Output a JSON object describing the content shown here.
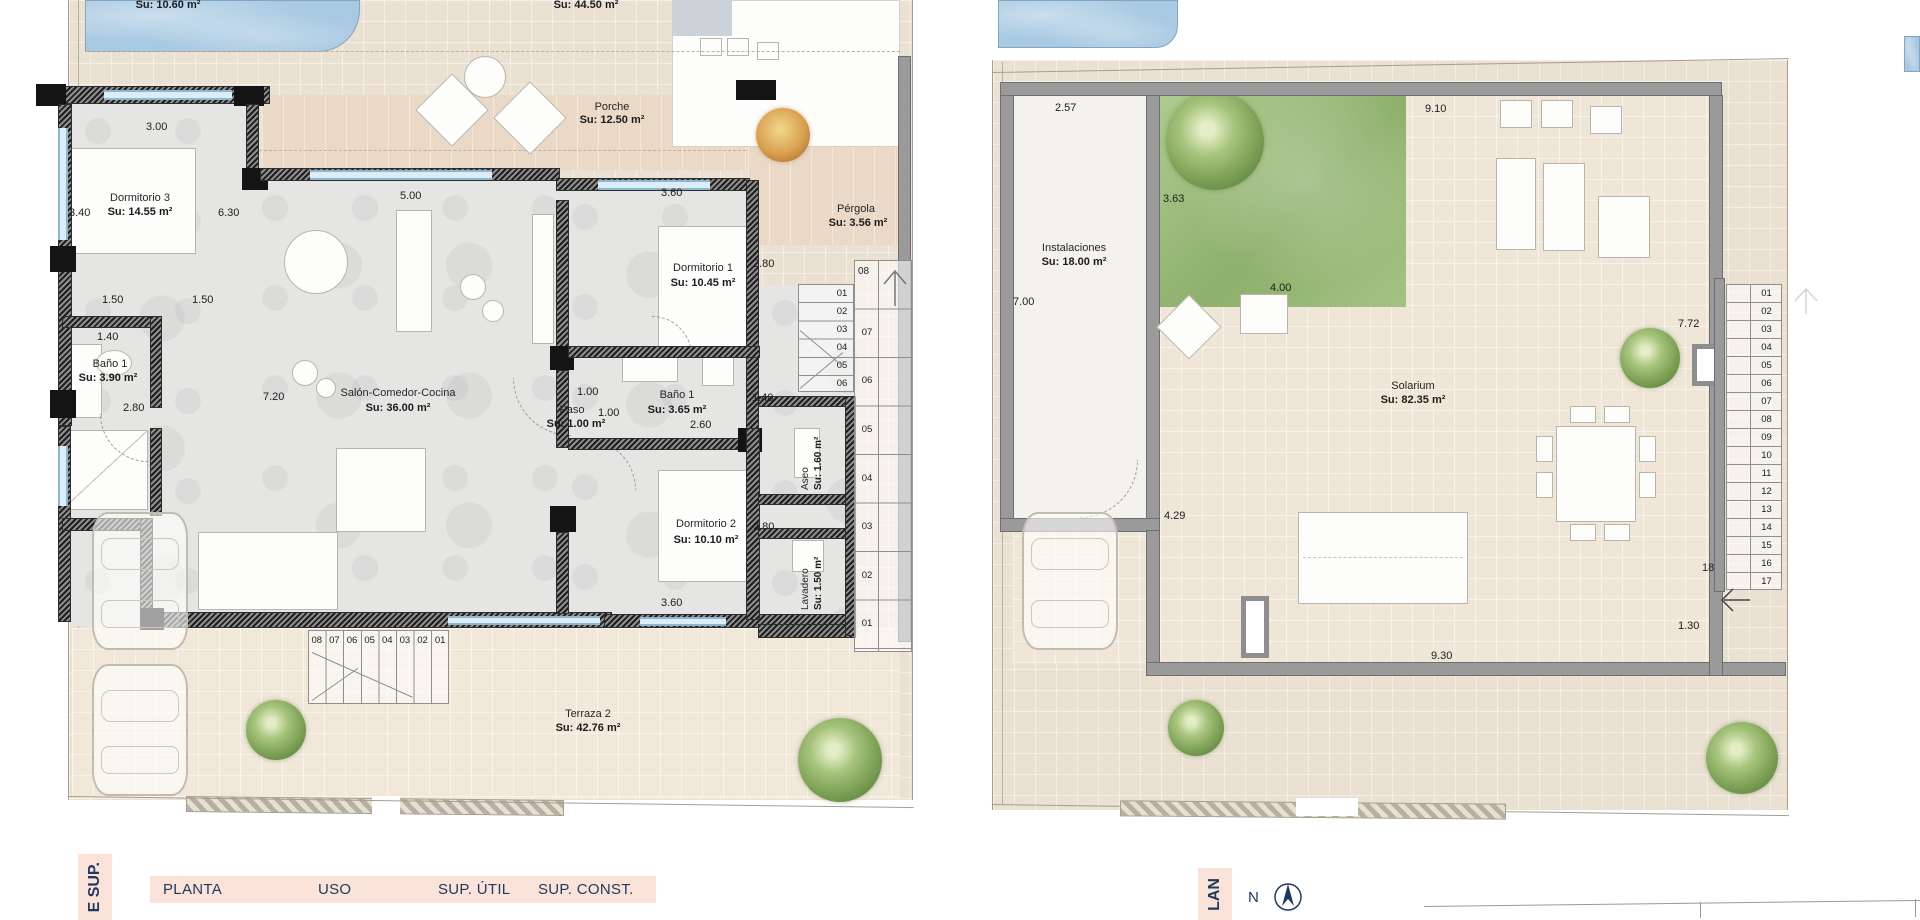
{
  "left_plan": {
    "outdoor": {
      "pool_area": "Su: 10.60 m²",
      "terrace_top_area": "Su: 44.50 m²",
      "porche_name": "Porche",
      "porche_area": "Su: 12.50 m²",
      "pergola_name": "Pérgola",
      "pergola_area": "Su: 3.56 m²",
      "terraza2_name": "Terraza 2",
      "terraza2_area": "Su: 42.76 m²"
    },
    "rooms": {
      "dorm3_name": "Dormitorio 3",
      "dorm3_area": "Su: 14.55 m²",
      "bano1_name": "Baño 1",
      "bano1_area": "Su: 3.90 m²",
      "salon_name": "Salón-Comedor-Cocina",
      "salon_area": "Su: 36.00 m²",
      "dorm1_name": "Dormitorio 1",
      "dorm1_area": "Su: 10.45 m²",
      "paso_name": "Paso",
      "paso_area": "Su: 1.00 m²",
      "bano2_name": "Baño 1",
      "bano2_area": "Su: 3.65 m²",
      "dorm2_name": "Dormitorio 2",
      "dorm2_area": "Su: 10.10 m²",
      "aseo_name": "Aseo",
      "aseo_area": "Su: 1.60 m²",
      "lavadero_name": "Lavadero",
      "lavadero_area": "Su: 1.50 m²"
    },
    "dims": {
      "a": "3.00",
      "b": "3.40",
      "c": "6.30",
      "d": "1.50",
      "e": "1.50",
      "f": "1.40",
      "g": "2.80",
      "h": "7.20",
      "i": "5.00",
      "j": "3.60",
      "k": "2.80",
      "l": "1.00",
      "m": "1.00",
      "n": "2.60",
      "o": "1.40",
      "p": "2.80",
      "q": "3.60"
    },
    "stairs": {
      "top": "08",
      "outer": [
        "07",
        "06",
        "05",
        "04",
        "03",
        "02",
        "01"
      ],
      "inner": [
        "01",
        "02",
        "03",
        "04",
        "05",
        "06"
      ],
      "bottom": [
        "08",
        "07",
        "06",
        "05",
        "04",
        "03",
        "02",
        "01"
      ]
    }
  },
  "right_plan": {
    "rooms": {
      "inst_name": "Instalaciones",
      "inst_area": "Su: 18.00 m²",
      "sol_name": "Solarium",
      "sol_area": "Su: 82.35 m²"
    },
    "dims": {
      "a": "2.57",
      "b": "9.10",
      "c": "3.63",
      "d": "7.00",
      "e": "4.00",
      "f": "7.72",
      "g": "4.29",
      "h": "9.30",
      "i": "1.30",
      "j": "18"
    },
    "stairs": [
      "01",
      "02",
      "03",
      "04",
      "05",
      "06",
      "07",
      "08",
      "09",
      "10",
      "11",
      "12",
      "13",
      "14",
      "15",
      "16",
      "17"
    ]
  },
  "footer": {
    "left_tab": "E SUP.",
    "right_tab": "LAN",
    "columns": [
      "PLANTA",
      "USO",
      "SUP. ÚTIL",
      "SUP. CONST."
    ],
    "compass": "N"
  },
  "colors": {
    "tab_bg": "#fbe3da",
    "navy_text": "#20395e",
    "pool_blue": "#a8c9e2",
    "garden_green": "#8db06b",
    "wall_dark": "#6e6e6e",
    "wall_gray": "#9a9a9a"
  }
}
